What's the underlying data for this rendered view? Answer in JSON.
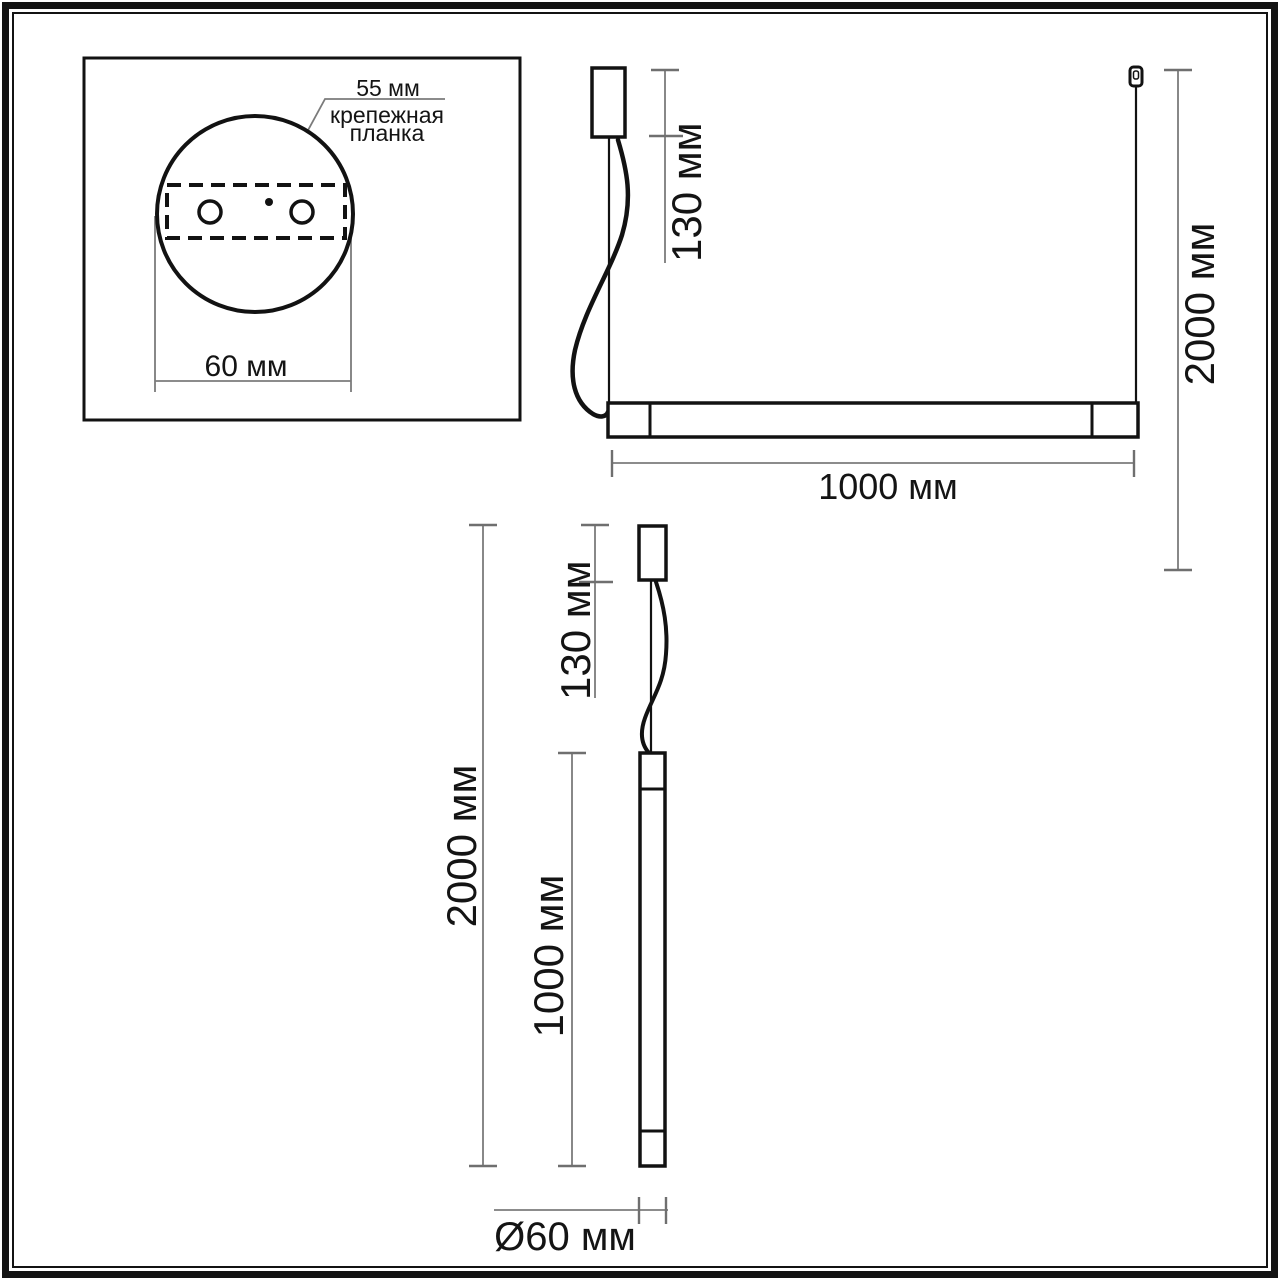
{
  "figure": {
    "background": "#ffffff",
    "line_color": "#121212",
    "dimension_color": "#7b7b7b",
    "text_color": "#141414",
    "detail_view": {
      "dim_55": "55 мм",
      "mount_label_line1": "крепежная",
      "mount_label_line2": "планка",
      "dim_60": "60 мм"
    },
    "horizontal_view": {
      "dim_canopy_130": "130 мм",
      "dim_drop_2000": "2000 мм",
      "dim_length_1000": "1000 мм"
    },
    "vertical_view": {
      "dim_canopy_130": "130 мм",
      "dim_drop_2000": "2000 мм",
      "dim_length_1000": "1000 мм",
      "dim_diameter_60": "Ø60 мм"
    }
  }
}
